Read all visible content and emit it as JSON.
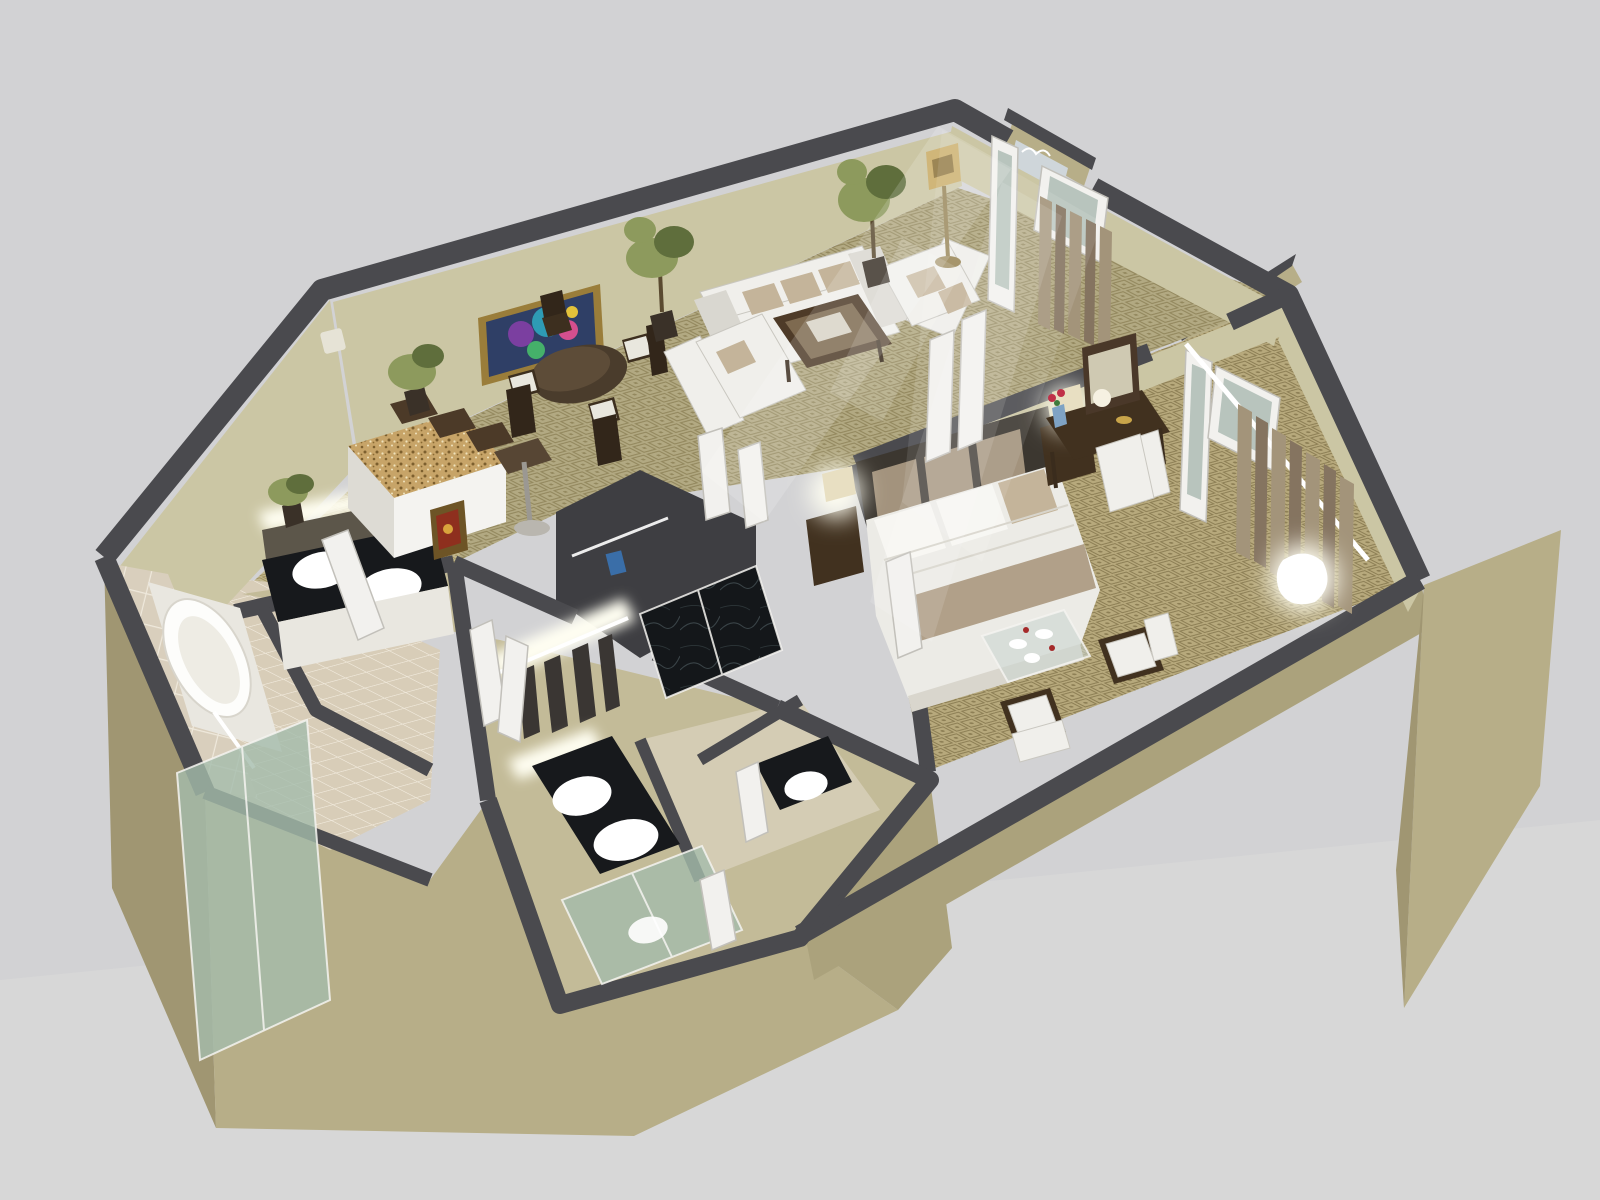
{
  "title": "3d-floor-plan-rendering",
  "colors": {
    "bg": "#d2d2d4",
    "bgLow": "#d8d8d9",
    "wallTop": "#4a4a4e",
    "wallTopDark": "#3e3e42",
    "faceIn": "#cbc6a4",
    "faceInLit": "#dad5b6",
    "faceOut": "#b7ae88",
    "faceOutMid": "#aba27c",
    "faceOutDark": "#a09672",
    "carpetBase": "#b2a982",
    "carpetMotif": "#93885e",
    "carpetBed": "#b7a97c",
    "carpetBedMotif": "#8d7f55",
    "carpetPale": "#c3bb98",
    "kitchenFloor": "#c2b78e",
    "kitchenMotif": "#a0925f",
    "bathTile": "#d8cdb8",
    "tileGrout": "#efe8da",
    "counterBlack": "#17191c",
    "marble": "#14171a",
    "granite": "#c7a468",
    "graniteSpeck": "#7c5f2e",
    "white": "#f4f3f0",
    "softWhite": "#e9e7e0",
    "sofa": "#f0efeb",
    "sofaEdge": "#c9c7c0",
    "sofaShad": "#d9d7d0",
    "cushion": "#c4b49a",
    "woodDark": "#41311f",
    "woodMid": "#6b543a",
    "linen": "#ecebe6",
    "runner": "#b1a089",
    "headboard": "#3c3730",
    "hbPanel": "#a3937d",
    "glassGreen": "#a4bcab",
    "glassBlue": "#b8c4bd",
    "glow": "#fffef2",
    "brass": "#c8a860",
    "curtain": "#a3947a",
    "curtainDark": "#857460",
    "plant": "#8d9a5d",
    "plantDark": "#5f6e3c",
    "pot": "#3a3128",
    "doorLeaf": "#f2f1ee",
    "doorEdge": "#c2c0ba",
    "paneGlass": "#b8c4bd",
    "paintFrame": "#9a7d3a",
    "paintBg": "#2f3f66",
    "accentBlue": "#3a6ea8",
    "accentRed": "#a52a2a"
  },
  "scene": {
    "type": "isometric-3d-floor-plan",
    "rooms": [
      {
        "id": "living-dining-room",
        "furniture": [
          "three-seat-sofa",
          "loveseat",
          "armchair",
          "coffee-table",
          "round-dining-table",
          "dining-chairs",
          "abstract-painting",
          "ficus-plants",
          "floor-lamp",
          "thermostat"
        ]
      },
      {
        "id": "kitchen",
        "furniture": [
          "granite-island",
          "bar-stools",
          "bar-table",
          "potted-plant",
          "small-framed-art"
        ]
      },
      {
        "id": "entry-foyer",
        "furniture": [
          "double-entry-doors",
          "glass-transom",
          "entry-curtains"
        ]
      },
      {
        "id": "master-bedroom",
        "furniture": [
          "king-bed",
          "headboard",
          "nightstands",
          "table-lamps",
          "vanity-desk",
          "wall-mirror",
          "flower-vase",
          "desk-chair",
          "glass-coffee-table",
          "accent-chairs",
          "french-doors",
          "curtains",
          "floor-glow-lamp"
        ]
      },
      {
        "id": "master-bathroom",
        "furniture": [
          "bathtub",
          "tiled-wall",
          "double-sink-vanity",
          "glass-shower"
        ]
      },
      {
        "id": "dressing-hall",
        "furniture": [
          "closet-rod-clothes",
          "lit-alcove",
          "marble-shower"
        ]
      },
      {
        "id": "guest-bathroom",
        "furniture": [
          "double-sink-vanity",
          "glass-shower",
          "toilet"
        ]
      }
    ]
  }
}
